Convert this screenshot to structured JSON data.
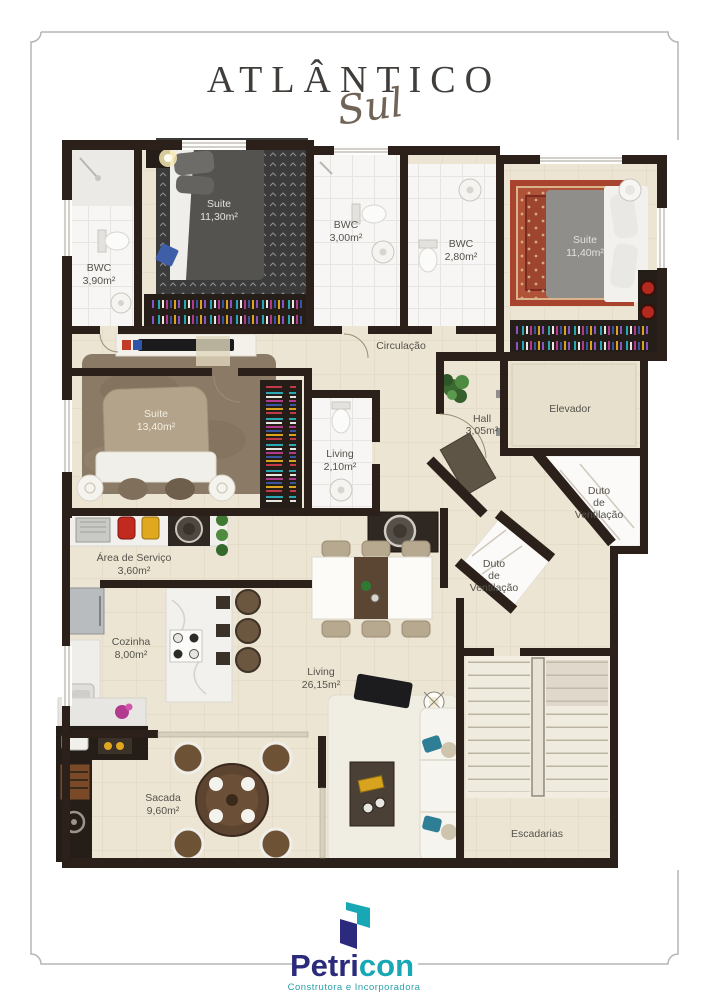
{
  "title": {
    "main": "ATLÂNTICO",
    "script": "Sul"
  },
  "rooms": {
    "bwc1": {
      "label": "BWC",
      "area": "3,90m²"
    },
    "suite1": {
      "label": "Suite",
      "area": "11,30m²"
    },
    "bwc2": {
      "label": "BWC",
      "area": "3,00m²"
    },
    "bwc3": {
      "label": "BWC",
      "area": "2,80m²"
    },
    "suite2": {
      "label": "Suite",
      "area": "11,40m²"
    },
    "circulacao": {
      "label": "Circulação"
    },
    "hall": {
      "label": "Hall",
      "area": "3,05m²"
    },
    "elevador": {
      "label": "Elevador"
    },
    "duto_right": {
      "line1": "Duto",
      "line2": "de",
      "line3": "Ventilação"
    },
    "duto_left": {
      "line1": "Duto",
      "line2": "de",
      "line3": "Ventilação"
    },
    "suite3": {
      "label": "Suite",
      "area": "13,40m²"
    },
    "lavabo": {
      "label": "Living",
      "area": "2,10m²"
    },
    "servico": {
      "label": "Área de Serviço",
      "area": "3,60m²"
    },
    "cozinha": {
      "label": "Cozinha",
      "area": "8,00m²"
    },
    "living": {
      "label": "Living",
      "area": "26,15m²"
    },
    "sacada": {
      "label": "Sacada",
      "area": "9,60m²"
    },
    "escadarias": {
      "label": "Escadarias"
    }
  },
  "branding": {
    "logo_left": "Petri",
    "logo_right": "con",
    "tagline": "Construtora e Incorporadora",
    "colors": {
      "navy": "#2b2a7c",
      "teal": "#18a7b5"
    }
  },
  "palette": {
    "wall": "#2b211a",
    "floor": "#ece5d4",
    "frame": "#b5b5b5"
  }
}
